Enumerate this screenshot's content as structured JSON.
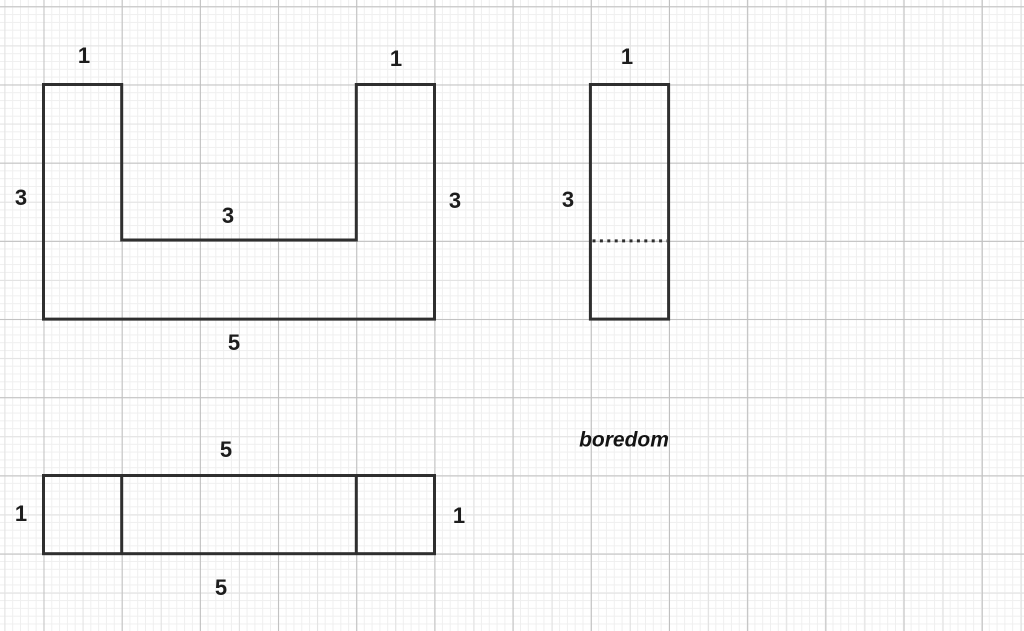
{
  "canvas": {
    "background_color": "#ffffff",
    "grid": {
      "minor_color": "#efefef",
      "medium_color": "#e2e2e2",
      "major_color": "#c0c0c0",
      "minor_step_px": 7.82,
      "major_step_px": 78.2
    },
    "stroke_color": "#2f2f2f"
  },
  "views": {
    "front": {
      "description": "U-shaped front view, 5 wide x 3 tall with 3x2 notch",
      "labels": {
        "top_left": "1",
        "top_right": "1",
        "left": "3",
        "right": "3",
        "inner": "3",
        "bottom": "5"
      }
    },
    "side": {
      "description": "side view, 1 wide x 3 tall with hidden dotted edge",
      "labels": {
        "top": "1",
        "left": "3"
      }
    },
    "top": {
      "description": "top view, 5 wide x 1 tall divided 1-3-1",
      "labels": {
        "top": "5",
        "left": "1",
        "right": "1",
        "bottom": "5"
      }
    }
  },
  "annotation": {
    "text": "boredom"
  }
}
